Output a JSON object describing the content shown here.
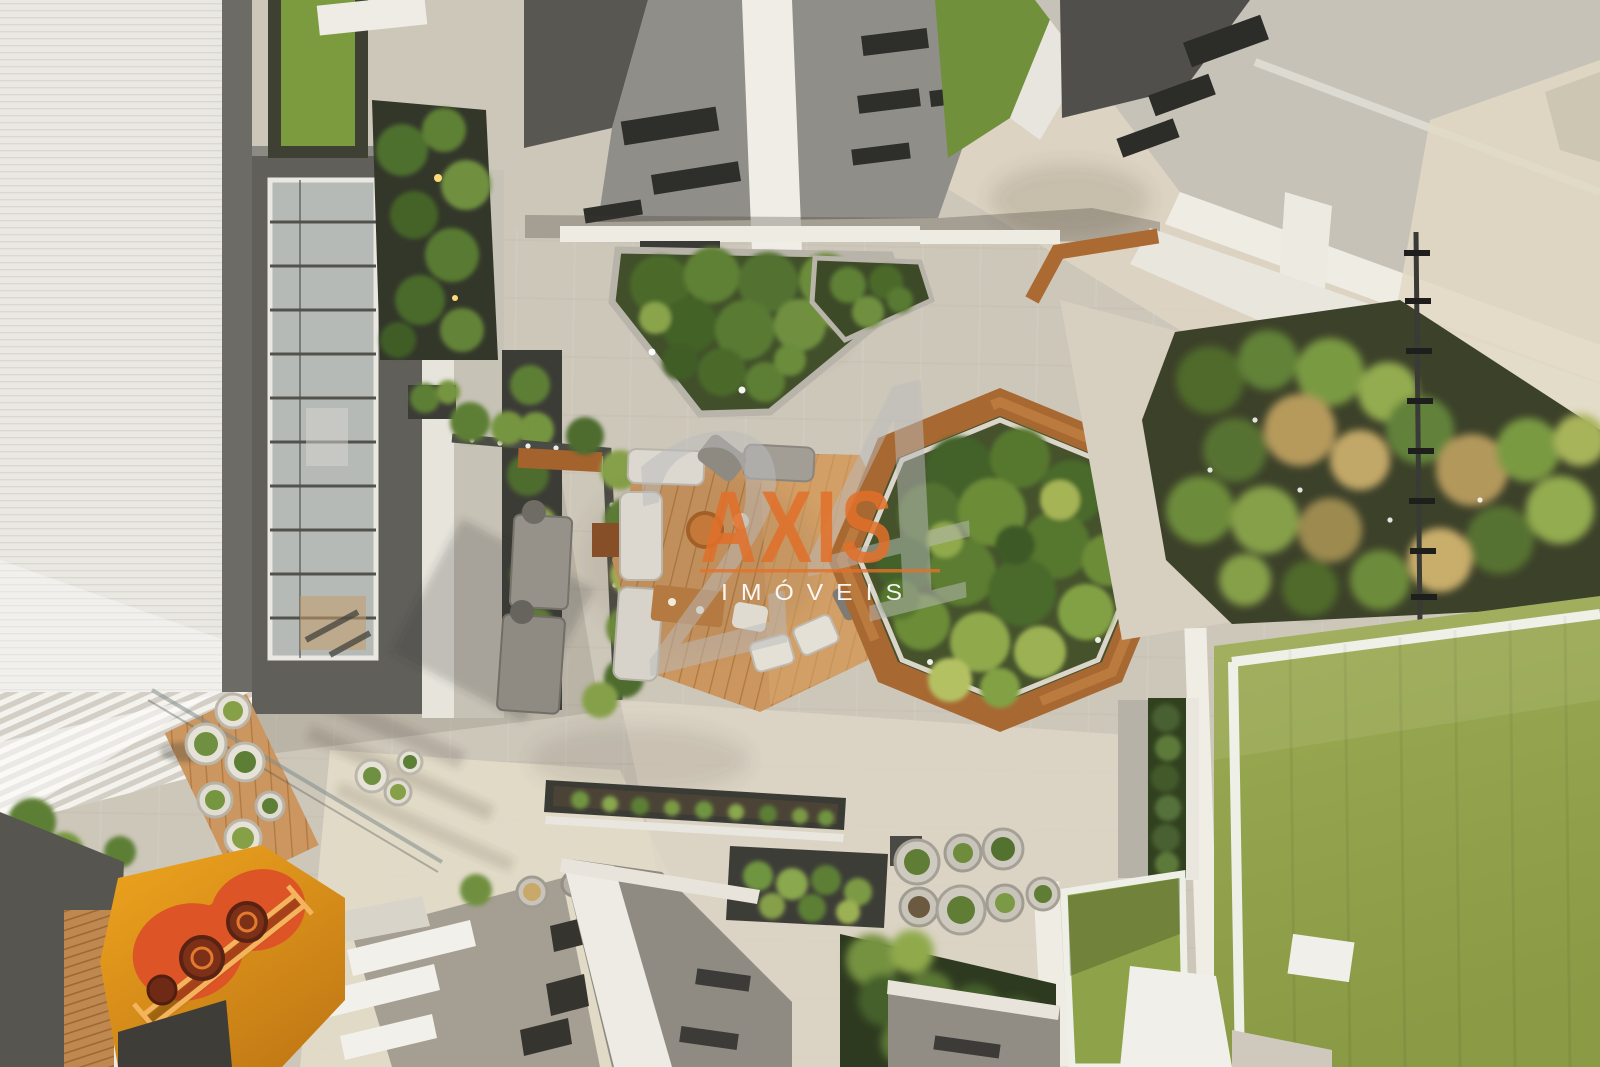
{
  "watermark": {
    "number": "24",
    "brand": "AXIS",
    "subtitle": "IMÓVEIS"
  },
  "colors": {
    "brand": "#e2702a",
    "watermark_number": "#bcbcbc",
    "watermark_subtitle": "#ffffff",
    "paving": "#cdc7ba",
    "paving_sunlit": "#e3dbc8",
    "roof_white": "#eceae3",
    "building_gray": "#8f8d87",
    "building_dark": "#575651",
    "turf_green": "#95a44d",
    "garden_green": "#5d7c33",
    "wood_deck": "#c99460",
    "wood_bench": "#a76832",
    "playground_orange": "#e89c1e",
    "playground_red": "#dd5526"
  }
}
